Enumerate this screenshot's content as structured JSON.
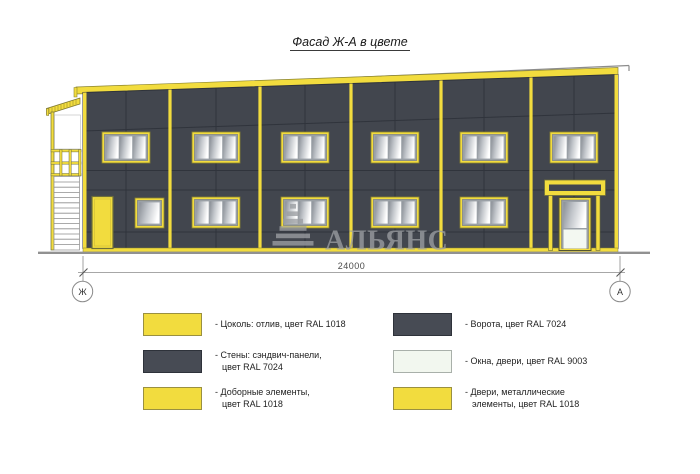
{
  "title": "Фасад Ж-А в цвете",
  "drawing": {
    "dimension_label": "24000",
    "axis_left": "Ж",
    "axis_right": "А",
    "watermark_text": "АЛЬЯНС"
  },
  "colors": {
    "accent_yellow_ral1018": "#F2DC3E",
    "wall_dark_ral7024": "#42464E",
    "window_white_ral9003": "#F2F7EF"
  },
  "legend": {
    "items": [
      {
        "swatch": "yellow",
        "line1": "- Цоколь: отлив, цвет RAL 1018",
        "line2": ""
      },
      {
        "swatch": "dark",
        "line1": "- Стены: сэндвич-панели,",
        "line2": "цвет RAL 7024"
      },
      {
        "swatch": "yellow",
        "line1": "- Доборные элементы,",
        "line2": "цвет RAL 1018"
      },
      {
        "swatch": "dark",
        "line1": "- Ворота, цвет RAL 7024",
        "line2": ""
      },
      {
        "swatch": "light",
        "line1": "- Окна, двери, цвет RAL 9003",
        "line2": ""
      },
      {
        "swatch": "yellow",
        "line1": "- Двери, металлические",
        "line2": "элементы, цвет RAL 1018"
      }
    ]
  }
}
